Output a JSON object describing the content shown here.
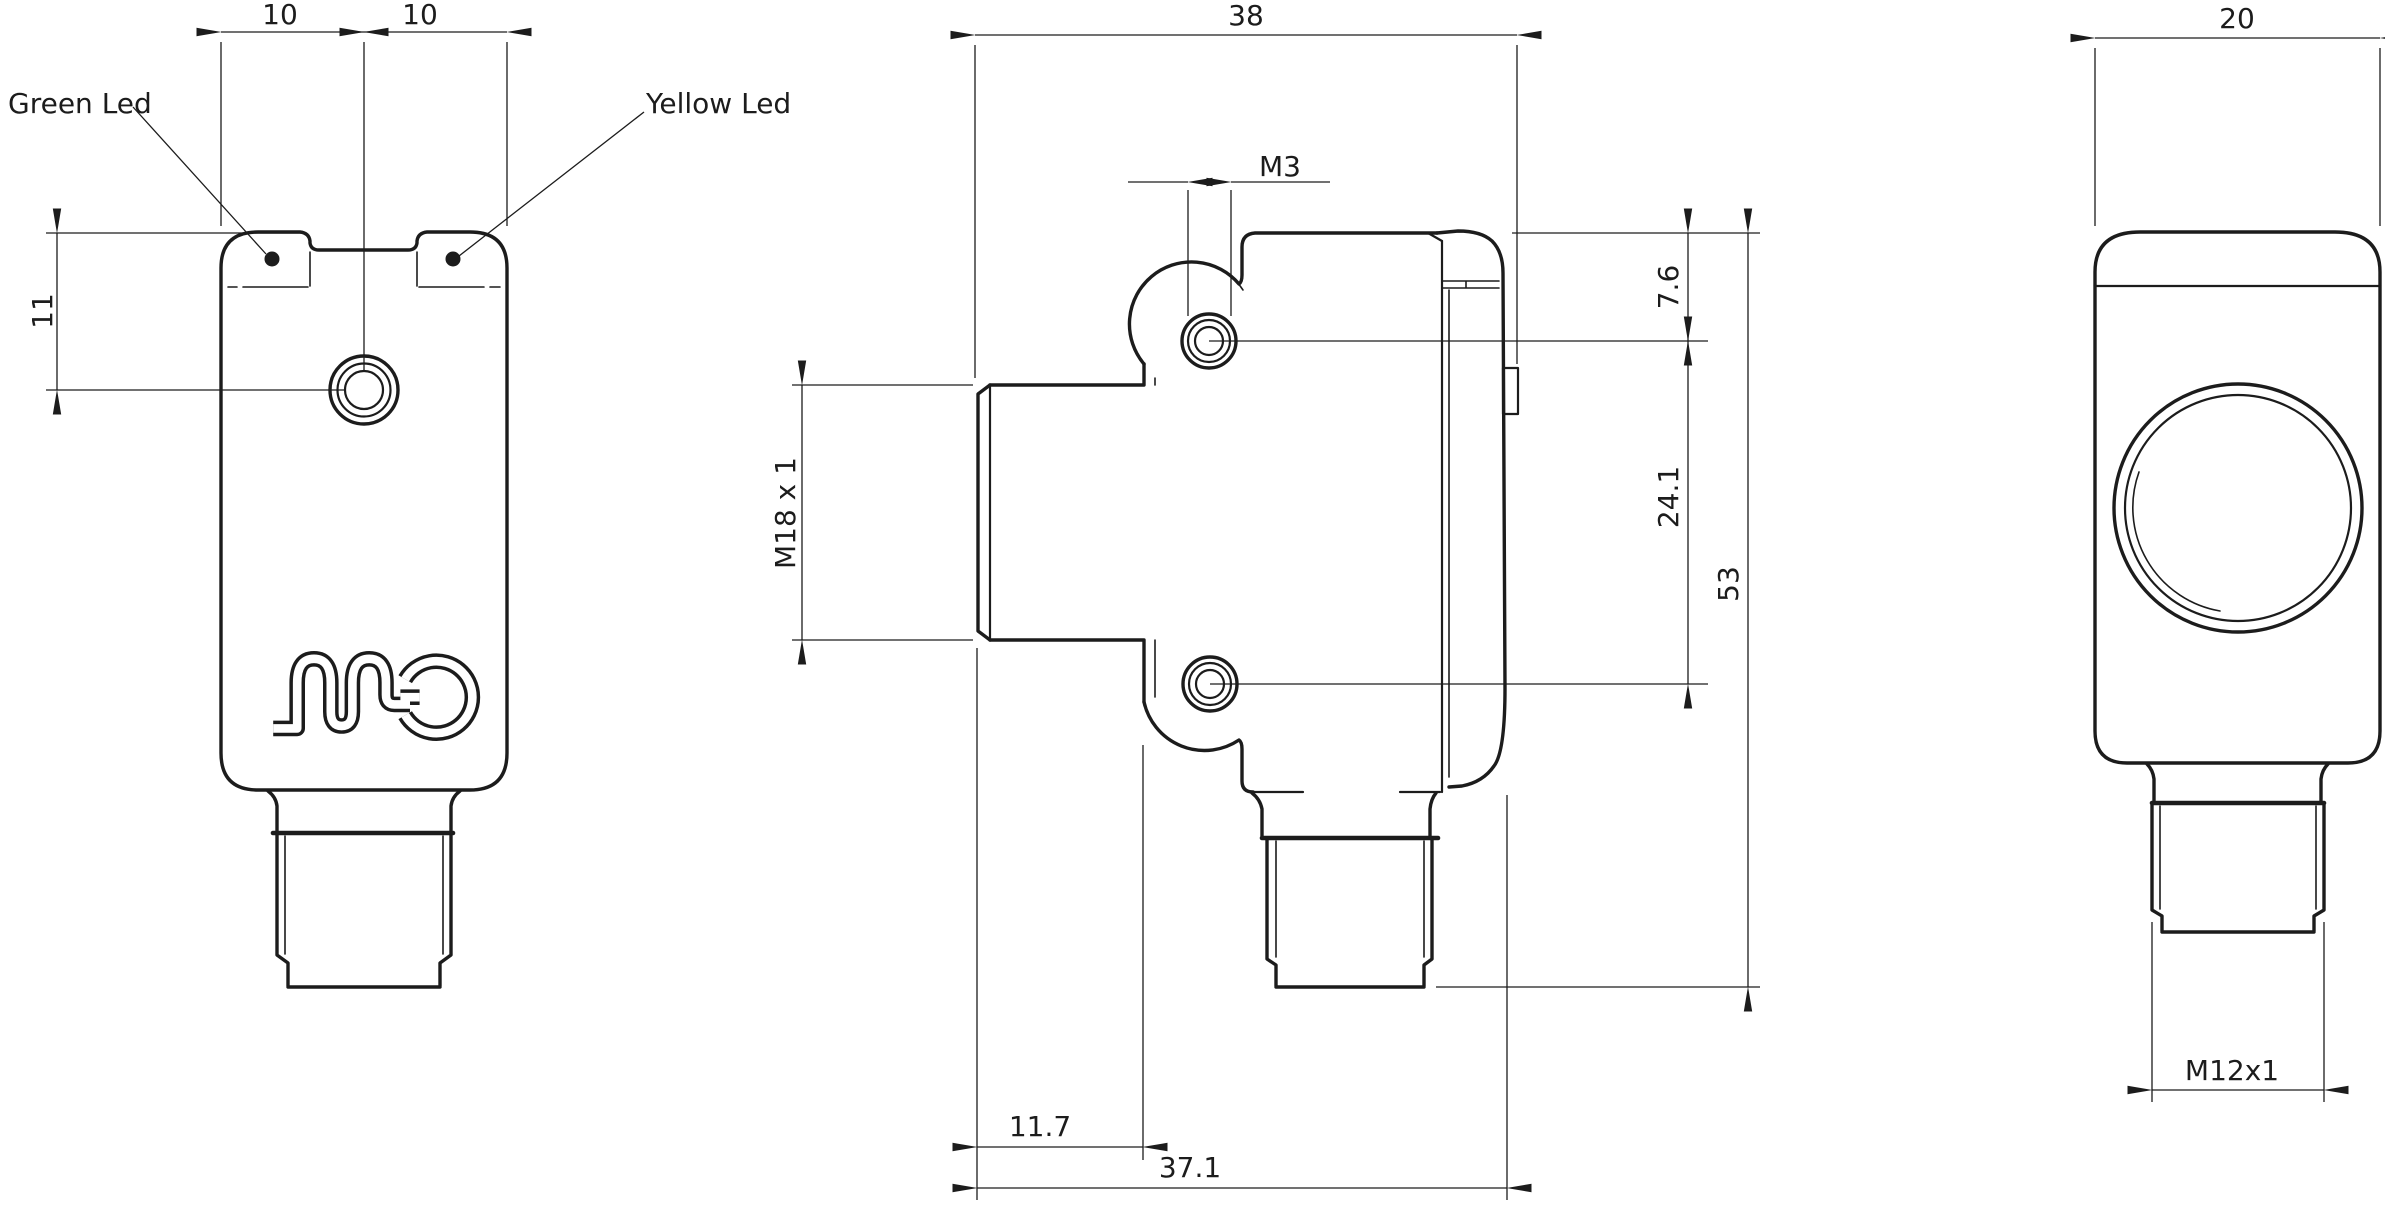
{
  "drawing": {
    "background": "#ffffff",
    "line_color": "#1c1c1c",
    "type": "technical-dimension-drawing",
    "views": [
      "front",
      "side",
      "rear"
    ]
  },
  "front_view": {
    "green_led_label": "Green Led",
    "yellow_led_label": "Yellow Led",
    "dim_width_left": "10",
    "dim_width_right": "10",
    "dim_led_offset": "11"
  },
  "side_view": {
    "dim_depth_total": "38",
    "dim_mount_hole": "M3",
    "dim_hole_top_offset": "7.6",
    "dim_hole_spacing": "24.1",
    "dim_height": "53",
    "dim_lens_thread": "M18 x 1",
    "dim_nose_length": "11.7",
    "dim_body_depth": "37.1"
  },
  "rear_view": {
    "dim_width": "20",
    "dim_connector_thread": "M12x1"
  }
}
